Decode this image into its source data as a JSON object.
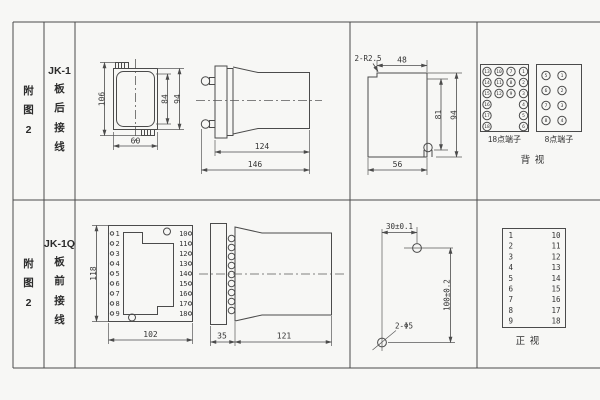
{
  "colors": {
    "background": "#f7f7f5",
    "line": "#4b4b4b",
    "text": "#333333"
  },
  "table": {
    "row1": {
      "fig": "附\n图\n2",
      "model": "JK-1",
      "wiring": "板\n后\n接\n线"
    },
    "row2": {
      "fig": "附\n图\n2",
      "model": "JK-1Q",
      "wiring": "板\n前\n接\n线"
    }
  },
  "rear_panel": {
    "height": "106",
    "inner_height": "84",
    "outer_height": "94",
    "width": "60"
  },
  "rear_side": {
    "depth_body": "124",
    "depth_total": "146"
  },
  "cutout": {
    "radius_callout": "2-R2.5",
    "width_top": "48",
    "height_inner": "81",
    "height_outer": "94",
    "width_bottom": "56"
  },
  "rear_terminals": {
    "block18": {
      "label": "18点端子",
      "r1": [
        "13",
        "10",
        "7",
        "1"
      ],
      "r2": [
        "14",
        "11",
        "8",
        "2"
      ],
      "r3": [
        "15",
        "12",
        "9",
        "3"
      ],
      "r4": [
        "16",
        "4"
      ],
      "r5": [
        "17",
        "5"
      ],
      "r6": [
        "18",
        "6"
      ]
    },
    "block8": {
      "label": "8点端子",
      "r1": [
        "5",
        "1"
      ],
      "r2": [
        "6",
        "2"
      ],
      "r3": [
        "7",
        "3"
      ],
      "r4": [
        "8",
        "4"
      ]
    },
    "view_label": "背  视"
  },
  "front_panel": {
    "left": [
      "1",
      "2",
      "3",
      "4",
      "5",
      "6",
      "7",
      "8",
      "9"
    ],
    "right": [
      "10",
      "11",
      "12",
      "13",
      "14",
      "15",
      "16",
      "17",
      "18"
    ],
    "height": "118",
    "width": "102"
  },
  "front_side": {
    "plate": "35",
    "body": "121"
  },
  "drill": {
    "spacing_h": "30±0.1",
    "spacing_v": "100±0.2",
    "holes": "2-Φ5"
  },
  "front_table": {
    "left": [
      "1",
      "2",
      "3",
      "4",
      "5",
      "6",
      "7",
      "8",
      "9"
    ],
    "right": [
      "10",
      "11",
      "12",
      "13",
      "14",
      "15",
      "16",
      "17",
      "18"
    ],
    "view_label": "正  视"
  }
}
